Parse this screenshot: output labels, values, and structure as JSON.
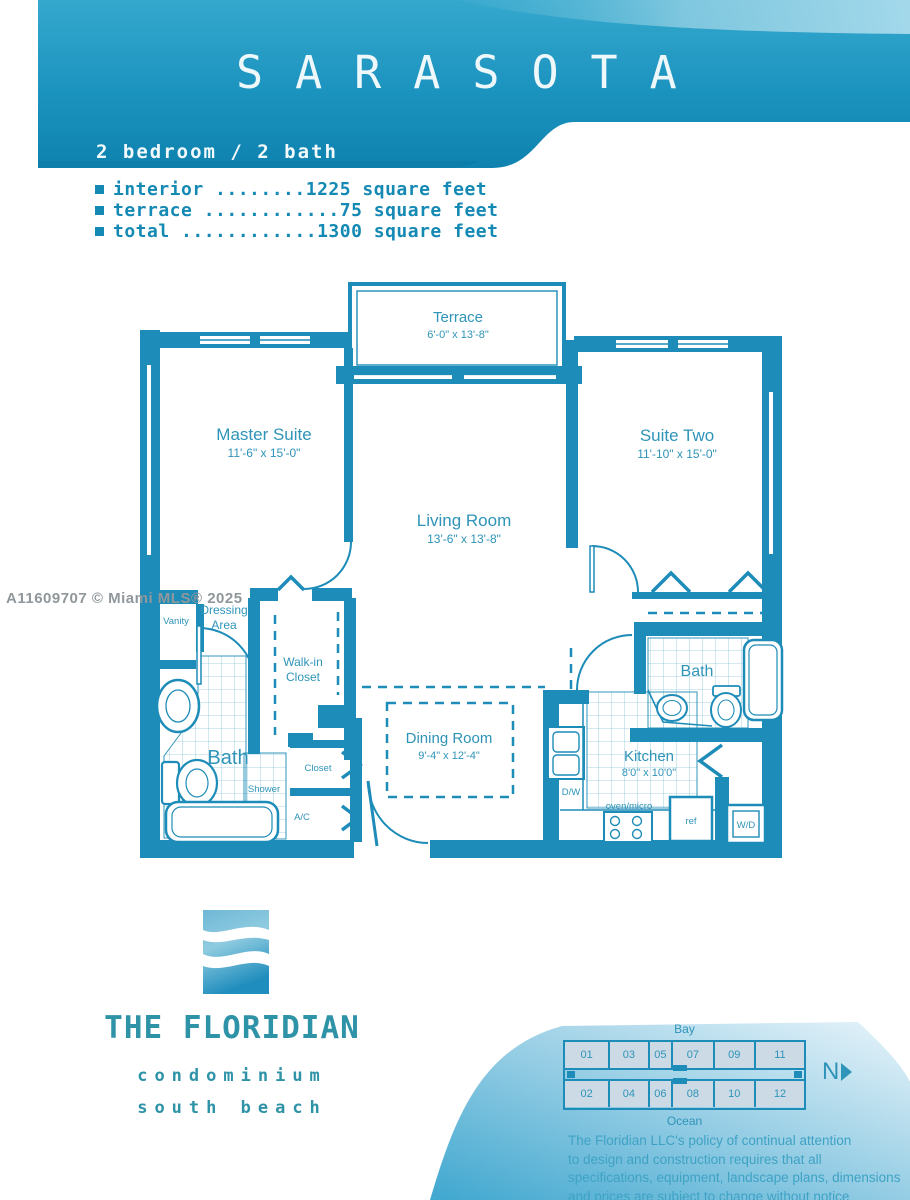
{
  "header": {
    "title": "SARASOTA",
    "subtitle": "2 bedroom / 2 bath"
  },
  "stats": {
    "lines": [
      "interior ........1225 square feet",
      "terrace ............75 square feet",
      "total ............1300 square feet"
    ]
  },
  "watermark": "A11609707 © Miami MLS® 2025",
  "plan": {
    "rooms": {
      "terrace": {
        "name": "Terrace",
        "dims": "6'-0\" x 13'-8\""
      },
      "master": {
        "name": "Master Suite",
        "dims": "11'-6\" x 15'-0\""
      },
      "living": {
        "name": "Living Room",
        "dims": "13'-6\" x 13'-8\""
      },
      "suite_two": {
        "name": "Suite Two",
        "dims": "11'-10\" x 15'-0\""
      },
      "dining": {
        "name": "Dining Room",
        "dims": "9'-4\" x 12'-4\""
      },
      "kitchen": {
        "name": "Kitchen",
        "dims": "8'0\" x 10'0\""
      }
    },
    "labels": {
      "bath1": "Bath",
      "bath2": "Bath",
      "walkin1": "Walk-in",
      "walkin2": "Closet",
      "dressing1": "Dressing",
      "dressing2": "Area",
      "vanity": "Vanity",
      "shower": "Shower",
      "closet": "Closet",
      "ac": "A/C",
      "dw": "D/W",
      "oven": "oven/micro",
      "ref": "ref",
      "wd": "W/D"
    }
  },
  "logo": {
    "name": "THE FLORIDIAN",
    "sub1": "condominium",
    "sub2": "south beach"
  },
  "keyplan": {
    "bay": "Bay",
    "ocean": "Ocean",
    "north": "N",
    "units_top": [
      "01",
      "03",
      "05",
      "07",
      "09",
      "11"
    ],
    "units_bottom": [
      "02",
      "04",
      "06",
      "08",
      "10",
      "12"
    ]
  },
  "disclaimer": {
    "lines": [
      "The Floridian LLC's policy of continual attention",
      "to design and construction requires that all",
      "specifications, equipment, landscape plans, dimensions",
      "and prices are subject to change without notice"
    ]
  },
  "colors": {
    "plan_teal": "#1d8cb8",
    "banner_dark": "#0d7ca9",
    "stats_teal": "#1489b4",
    "logo_teal": "#2f93a8",
    "disclaimer_teal": "#3ea2c4"
  }
}
